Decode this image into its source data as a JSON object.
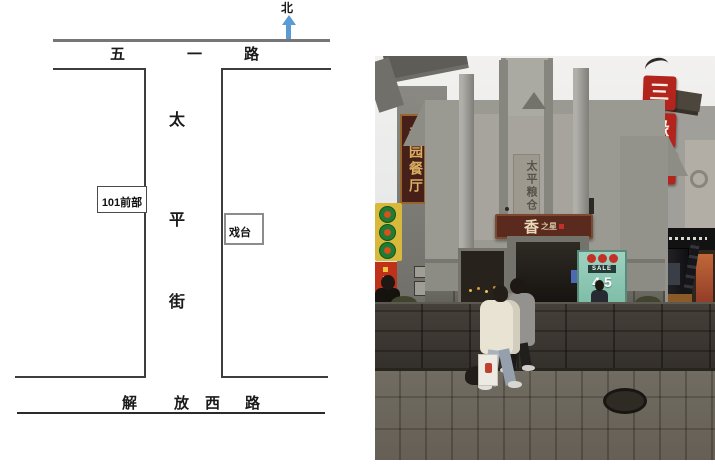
{
  "figure": {
    "map": {
      "compass": {
        "label": "北",
        "arrow_color": "#5B9BD5"
      },
      "top_road": {
        "name": "五一路",
        "chars": [
          "五",
          "一",
          "路"
        ]
      },
      "street": {
        "name": "太平街",
        "chars": [
          "太",
          "平",
          "街"
        ]
      },
      "bottom_road": {
        "name": "解放西路",
        "chars": [
          "解",
          "放",
          "西",
          "路"
        ]
      },
      "boxes": {
        "front101": "101前部",
        "stage": "戏台"
      }
    },
    "photo": {
      "left_sign": {
        "text": "沁园餐厅",
        "bg": "#46211B",
        "fg": "#D9AE62"
      },
      "inscription": {
        "text": "太平粮仓"
      },
      "entrance_sign": {
        "main": "香",
        "small": "之星",
        "bg": "#5A2A1F"
      },
      "right_signs": {
        "chars": [
          "三",
          "缘",
          "堂"
        ],
        "bg": "#B2241C"
      },
      "poster": {
        "label": "SALE",
        "value": "4.5",
        "bg": "#8FCAB8"
      }
    }
  }
}
